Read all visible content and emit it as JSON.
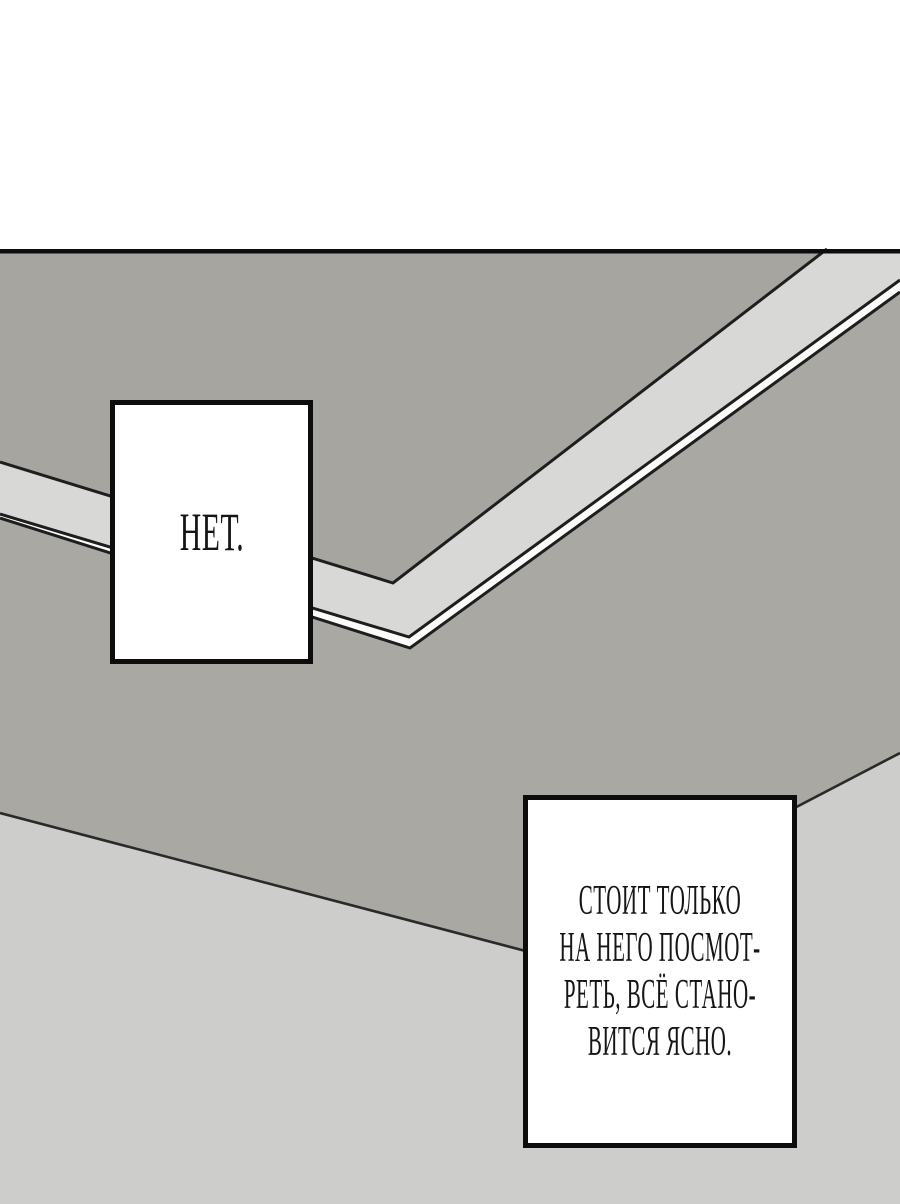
{
  "colors": {
    "page_bg": "#ffffff",
    "panel_border": "#0d0d0d",
    "board_back": "#a6a59f",
    "edge_band": "#d8d8d6",
    "edge_side": "#fbfbfa",
    "tabletop": "#a9a8a2",
    "floor": "#cdcdcc",
    "line": "#1e1e1e",
    "bubble_bg": "#ffffff",
    "bubble_border": "#0d0d0d",
    "text": "#151515"
  },
  "bubbles": {
    "net": {
      "text": "НЕТ."
    },
    "explanation": {
      "lines": [
        "СТОИТ ТОЛЬКО",
        "НА НЕГО ПОСМОТ-",
        "РЕТЬ, ВСЁ СТАНО-",
        "ВИТСЯ ЯСНО."
      ]
    }
  }
}
